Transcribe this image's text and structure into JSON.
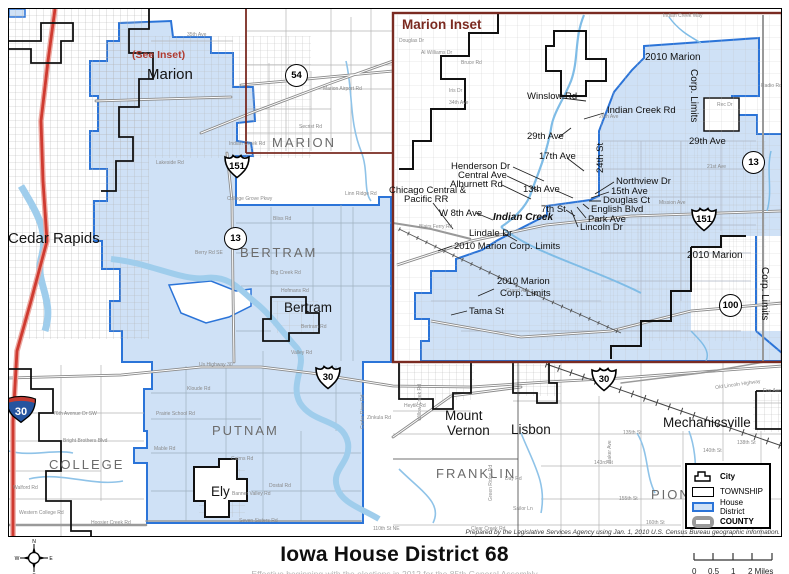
{
  "title": "Iowa House District 68",
  "subtitle": "Effective beginning with the elections in 2012 for the 85th General Assembly",
  "attribution": "Prepared by the Legislative Services Agency using Jan. 1, 2010 U.S. Census Bureau geographic information.",
  "colors": {
    "district_fill": "#cfe1f6",
    "district_border": "#2b74d8",
    "county_line": "#7a2b22",
    "water": "#9fcdec",
    "interstate_road": "#cf3a30",
    "road": "#8a8a8a",
    "city_boundary": "#111111"
  },
  "compass": {
    "n": "N",
    "e": "E",
    "s": "S",
    "w": "W"
  },
  "scale_bar": {
    "labels": [
      "0",
      "0.5",
      "1",
      "2 Miles"
    ]
  },
  "legend": {
    "items": [
      {
        "label": "City",
        "type": "city",
        "bold": true
      },
      {
        "label": "TOWNSHIP",
        "type": "township",
        "bold": false
      },
      {
        "label": "House District",
        "type": "house-district",
        "bold": false
      },
      {
        "label": "COUNTY",
        "type": "county",
        "bold": true
      }
    ]
  },
  "main_map": {
    "labels": [
      {
        "text": "(See Inset)",
        "cls": "seeinset",
        "x": 131,
        "y": 49
      },
      {
        "text": "Marion",
        "cls": "city",
        "x": 146,
        "y": 66,
        "size": 15
      },
      {
        "text": "MARION",
        "cls": "twp",
        "x": 271,
        "y": 135
      },
      {
        "text": "Cedar Rapids",
        "cls": "city",
        "x": 7,
        "y": 230,
        "size": 15
      },
      {
        "text": "BERTRAM",
        "cls": "twp",
        "x": 239,
        "y": 245
      },
      {
        "text": "Bertram",
        "cls": "city",
        "x": 283,
        "y": 300
      },
      {
        "text": "PUTNAM",
        "cls": "twp",
        "x": 211,
        "y": 423
      },
      {
        "text": "COLLEGE",
        "cls": "twp",
        "x": 48,
        "y": 457
      },
      {
        "text": "Ely",
        "cls": "city",
        "x": 210,
        "y": 484
      },
      {
        "text": "Mount",
        "cls": "city",
        "x": 444,
        "y": 408
      },
      {
        "text": "Vernon",
        "cls": "city",
        "x": 446,
        "y": 423
      },
      {
        "text": "Lisbon",
        "cls": "city",
        "x": 510,
        "y": 422
      },
      {
        "text": "FRANKLIN",
        "cls": "twp",
        "x": 435,
        "y": 466
      },
      {
        "text": "Mechanicsville",
        "cls": "city",
        "x": 662,
        "y": 415
      },
      {
        "text": "PION",
        "cls": "twp",
        "x": 650,
        "y": 487
      },
      {
        "text": "35th Ave",
        "cls": "road",
        "x": 186,
        "y": 32
      },
      {
        "text": "Marion Airport Rd",
        "cls": "road",
        "x": 322,
        "y": 86
      },
      {
        "text": "Secrist Rd",
        "cls": "road",
        "x": 298,
        "y": 124
      },
      {
        "text": "Indian Creek Rd",
        "cls": "road",
        "x": 228,
        "y": 141
      },
      {
        "text": "Lakeside Rd",
        "cls": "road",
        "x": 155,
        "y": 160
      },
      {
        "text": "College Grove Pkwy",
        "cls": "road",
        "x": 226,
        "y": 196
      },
      {
        "text": "Linn Ridge Rd",
        "cls": "road",
        "x": 344,
        "y": 191
      },
      {
        "text": "Bliss Rd",
        "cls": "road",
        "x": 272,
        "y": 216
      },
      {
        "text": "Berry Rd SE",
        "cls": "road",
        "x": 194,
        "y": 250
      },
      {
        "text": "Big Creek Rd",
        "cls": "road",
        "x": 270,
        "y": 270
      },
      {
        "text": "Hofmans Rd",
        "cls": "road",
        "x": 280,
        "y": 288
      },
      {
        "text": "Bertram Rd",
        "cls": "road",
        "x": 300,
        "y": 324
      },
      {
        "text": "Valley Rd",
        "cls": "road",
        "x": 290,
        "y": 350
      },
      {
        "text": "Us Highway 30",
        "cls": "road",
        "x": 198,
        "y": 362
      },
      {
        "text": "Kloude Rd",
        "cls": "road",
        "x": 186,
        "y": 386
      },
      {
        "text": "Prairie School Rd",
        "cls": "road",
        "x": 155,
        "y": 411
      },
      {
        "text": "Mable Rd",
        "cls": "road",
        "x": 153,
        "y": 446
      },
      {
        "text": "Cairns Rd",
        "cls": "road",
        "x": 230,
        "y": 456
      },
      {
        "text": "Dostal Rd",
        "cls": "road",
        "x": 268,
        "y": 483
      },
      {
        "text": "Banner Valley Rd",
        "cls": "road",
        "x": 231,
        "y": 491
      },
      {
        "text": "Seven Sisters Rd",
        "cls": "road",
        "x": 238,
        "y": 518
      },
      {
        "text": "110th St NE",
        "cls": "road",
        "x": 372,
        "y": 526
      },
      {
        "text": "76th Avenue Dr SW",
        "cls": "road",
        "x": 52,
        "y": 411
      },
      {
        "text": "Bright Brothers Blvd",
        "cls": "road",
        "x": 62,
        "y": 438
      },
      {
        "text": "Walford Rd",
        "cls": "road",
        "x": 12,
        "y": 485
      },
      {
        "text": "Western College Rd",
        "cls": "road",
        "x": 18,
        "y": 510
      },
      {
        "text": "Hoosier Creek Rd",
        "cls": "road",
        "x": 90,
        "y": 520
      },
      {
        "text": "Zinkula Rd",
        "cls": "road",
        "x": 366,
        "y": 415
      },
      {
        "text": "Heytik Rd",
        "cls": "road",
        "x": 403,
        "y": 403
      },
      {
        "text": "140th St",
        "cls": "road",
        "x": 702,
        "y": 448
      },
      {
        "text": "138th St",
        "cls": "road",
        "x": 736,
        "y": 440
      },
      {
        "text": "135th St",
        "cls": "road",
        "x": 622,
        "y": 430
      },
      {
        "text": "143rd St",
        "cls": "road",
        "x": 593,
        "y": 460
      },
      {
        "text": "155th St",
        "cls": "road",
        "x": 618,
        "y": 496
      },
      {
        "text": "160th St",
        "cls": "road",
        "x": 645,
        "y": 520
      },
      {
        "text": "Fox Ave",
        "cls": "road",
        "x": 762,
        "y": 388
      },
      {
        "text": "Day Rd",
        "cls": "road",
        "x": 504,
        "y": 476
      },
      {
        "text": "Sailor Ln",
        "cls": "road",
        "x": 512,
        "y": 506
      },
      {
        "text": "Clear Creek Rd",
        "cls": "road",
        "x": 470,
        "y": 526
      },
      {
        "text": "Baker Ave",
        "cls": "road",
        "x": 607,
        "y": 462,
        "rot": -90
      },
      {
        "text": "Old Lincoln Highway",
        "cls": "road",
        "x": 714,
        "y": 385,
        "rot": -8
      },
      {
        "text": "Green Ridge Rd",
        "cls": "road",
        "x": 488,
        "y": 500,
        "rot": -90
      },
      {
        "text": "Willow Creek Rd",
        "cls": "road",
        "x": 417,
        "y": 420,
        "rot": -90
      },
      {
        "text": "Cedar River Rd",
        "cls": "road",
        "x": 360,
        "y": 428,
        "rot": -90
      }
    ],
    "shields": [
      {
        "num": "54",
        "type": "circle",
        "x": 284,
        "y": 63
      },
      {
        "num": "151",
        "type": "us",
        "x": 222,
        "y": 152
      },
      {
        "num": "13",
        "type": "circle",
        "x": 223,
        "y": 226
      },
      {
        "num": "30",
        "type": "us",
        "x": 313,
        "y": 363
      },
      {
        "num": "30",
        "type": "us",
        "x": 589,
        "y": 365
      },
      {
        "num": "30",
        "type": "interstate",
        "x": 3,
        "y": 392
      }
    ]
  },
  "inset": {
    "title": "Marion Inset",
    "labels": [
      {
        "text": "Winslow Rd",
        "cls": "street",
        "x": 526,
        "y": 91
      },
      {
        "text": "Indian Creek Rd",
        "cls": "street",
        "x": 606,
        "y": 105
      },
      {
        "text": "29th Ave",
        "cls": "street",
        "x": 526,
        "y": 131
      },
      {
        "text": "24th St",
        "cls": "street",
        "x": 595,
        "y": 172,
        "rot": -90
      },
      {
        "text": "17th Ave",
        "cls": "street",
        "x": 538,
        "y": 151
      },
      {
        "text": "Henderson Dr",
        "cls": "street",
        "x": 450,
        "y": 161
      },
      {
        "text": "Central Ave",
        "cls": "street",
        "x": 457,
        "y": 170
      },
      {
        "text": "Alburnett Rd",
        "cls": "street",
        "x": 449,
        "y": 179
      },
      {
        "text": "13th Ave",
        "cls": "street",
        "x": 522,
        "y": 184
      },
      {
        "text": "Northview Dr",
        "cls": "street",
        "x": 615,
        "y": 176
      },
      {
        "text": "15th Ave",
        "cls": "street",
        "x": 610,
        "y": 186
      },
      {
        "text": "Douglas Ct",
        "cls": "street",
        "x": 602,
        "y": 195
      },
      {
        "text": "English Blvd",
        "cls": "street",
        "x": 590,
        "y": 204
      },
      {
        "text": "Park Ave",
        "cls": "street",
        "x": 587,
        "y": 214
      },
      {
        "text": "Lincoln Dr",
        "cls": "street",
        "x": 579,
        "y": 222
      },
      {
        "text": "7th St",
        "cls": "street",
        "x": 540,
        "y": 204
      },
      {
        "text": "Indian Creek",
        "cls": "creek",
        "x": 492,
        "y": 212
      },
      {
        "text": "Chicago Central &",
        "cls": "street",
        "x": 388,
        "y": 185
      },
      {
        "text": "Pacific RR",
        "cls": "street",
        "x": 403,
        "y": 194
      },
      {
        "text": "W 8th Ave",
        "cls": "street",
        "x": 438,
        "y": 208
      },
      {
        "text": "Lindale Dr",
        "cls": "street",
        "x": 468,
        "y": 228
      },
      {
        "text": "2010 Marion Corp. Limits",
        "cls": "street",
        "x": 453,
        "y": 241
      },
      {
        "text": "2010 Marion",
        "cls": "street",
        "x": 496,
        "y": 276
      },
      {
        "text": "Corp. Limits",
        "cls": "street",
        "x": 499,
        "y": 288
      },
      {
        "text": "Tama St",
        "cls": "street",
        "x": 468,
        "y": 306
      },
      {
        "text": "2010 Marion",
        "cls": "corp",
        "x": 644,
        "y": 52
      },
      {
        "text": "Corp. Limits",
        "cls": "corp",
        "x": 697,
        "y": 68,
        "rot": 90
      },
      {
        "text": "29th Ave",
        "cls": "street",
        "x": 688,
        "y": 136
      },
      {
        "text": "2010 Marion",
        "cls": "corp",
        "x": 686,
        "y": 250
      },
      {
        "text": "Corp. Limits",
        "cls": "corp",
        "x": 768,
        "y": 266,
        "rot": 90
      },
      {
        "text": "Indian Creek Way",
        "cls": "road",
        "x": 662,
        "y": 13
      },
      {
        "text": "Radio Rd",
        "cls": "road",
        "x": 760,
        "y": 83
      },
      {
        "text": "Rec Dr",
        "cls": "road",
        "x": 716,
        "y": 102
      },
      {
        "text": "26th Ave",
        "cls": "road",
        "x": 598,
        "y": 114
      },
      {
        "text": "Mission Ave",
        "cls": "road",
        "x": 658,
        "y": 200
      },
      {
        "text": "21st Ave",
        "cls": "road",
        "x": 706,
        "y": 164
      },
      {
        "text": "Grand Ave",
        "cls": "road",
        "x": 505,
        "y": 288
      },
      {
        "text": "Douglas Dr",
        "cls": "road",
        "x": 398,
        "y": 38
      },
      {
        "text": "Al Williams Dr",
        "cls": "road",
        "x": 420,
        "y": 50
      },
      {
        "text": "Iris Dr",
        "cls": "road",
        "x": 448,
        "y": 88
      },
      {
        "text": "34th Ave",
        "cls": "road",
        "x": 448,
        "y": 100
      },
      {
        "text": "Bruce Rd",
        "cls": "road",
        "x": 460,
        "y": 60
      },
      {
        "text": "Blairs Ferry Rd",
        "cls": "road",
        "x": 418,
        "y": 224
      }
    ],
    "shields": [
      {
        "num": "13",
        "type": "circle",
        "x": 741,
        "y": 150
      },
      {
        "num": "151",
        "type": "us",
        "x": 689,
        "y": 205
      },
      {
        "num": "100",
        "type": "circle",
        "x": 718,
        "y": 293
      }
    ]
  }
}
